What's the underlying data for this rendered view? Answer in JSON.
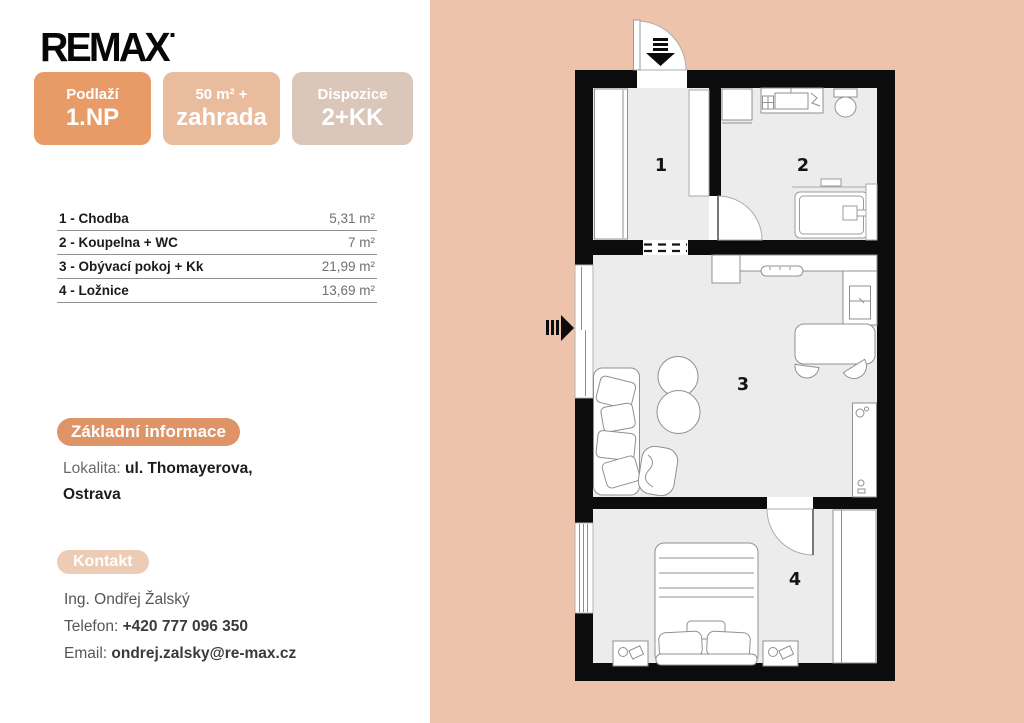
{
  "brand": {
    "logo_text": "REMAX"
  },
  "badges": [
    {
      "label": "Podlaží",
      "value": "1.NP",
      "bg": "#e89a67"
    },
    {
      "label": "50 m² +",
      "value": "zahrada",
      "bg": "#e9bc9e"
    },
    {
      "label": "Dispozice",
      "value": "2+KK",
      "bg": "#dbc6ba"
    }
  ],
  "rooms": [
    {
      "name": "1 - Chodba",
      "area": "5,31 m²"
    },
    {
      "name": "2 - Koupelna + WC",
      "area": "7 m²"
    },
    {
      "name": "3 - Obývací pokoj + Kk",
      "area": "21,99 m²"
    },
    {
      "name": "4 - Ložnice",
      "area": "13,69 m²"
    }
  ],
  "sections": {
    "info_title": "Základní informace",
    "lokalita_label": "Lokalita:",
    "lokalita_value_line1": "ul. Thomayerova,",
    "lokalita_value_line2": "Ostrava",
    "contact_title": "Kontakt",
    "agent": "Ing. Ondřej Žalský",
    "phone_label": "Telefon:",
    "phone": "+420 777 096 350",
    "email_label": "Email:",
    "email": "ondrej.zalsky@re-max.cz"
  },
  "floorplan": {
    "room_numbers": [
      "1",
      "2",
      "3",
      "4"
    ],
    "colors": {
      "panel_bg": "#edc3ac",
      "wall": "#0c0c0c",
      "room_fill": "#ececec",
      "furniture_stroke": "#909090",
      "badge1_bg": "#e89a67",
      "badge2_bg": "#e9bc9e",
      "badge3_bg": "#dbc6ba",
      "info_pill_bg": "#df9468",
      "contact_pill_bg": "#edccb5"
    }
  }
}
